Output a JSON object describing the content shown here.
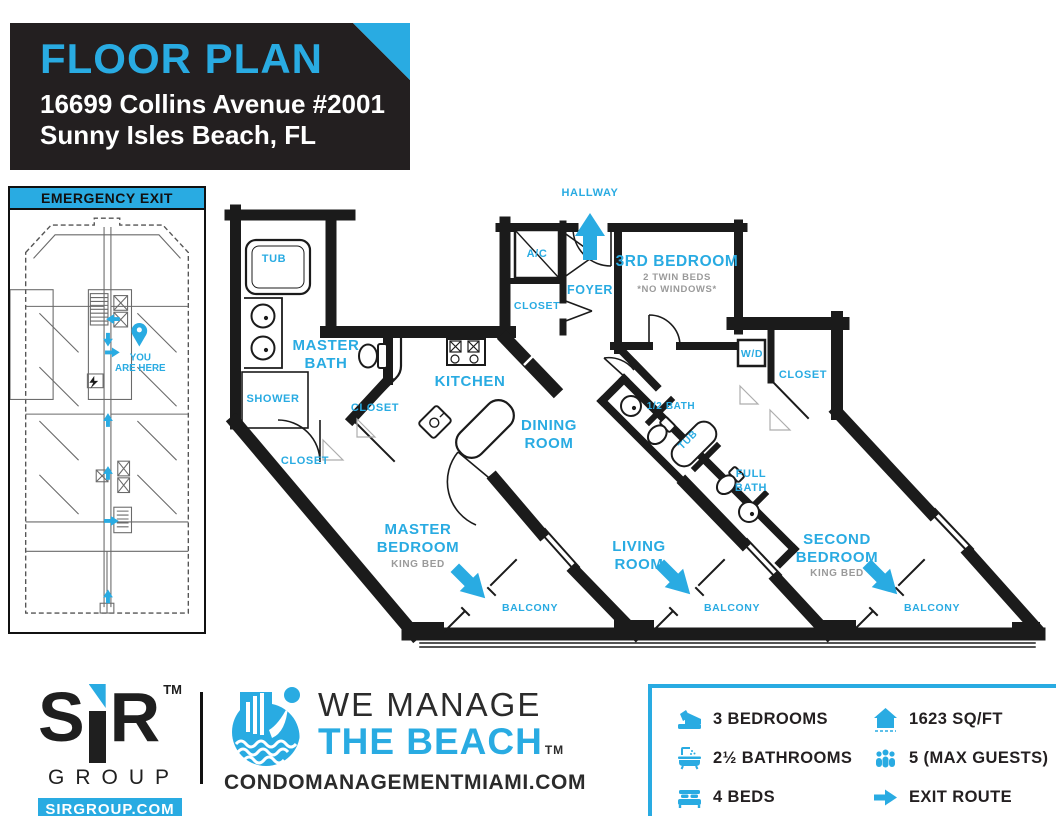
{
  "colors": {
    "accent": "#29ABE2",
    "ink": "#231F20",
    "wall": "#1B1B1B",
    "sub_gray": "#9A9A9A"
  },
  "header": {
    "title": "FLOOR PLAN",
    "address_line1": "16699 Collins Avenue #2001",
    "address_line2": "Sunny Isles Beach, FL"
  },
  "emergency": {
    "title": "EMERGENCY EXIT",
    "marker_line1": "YOU",
    "marker_line2": "ARE HERE"
  },
  "floorplan": {
    "hallway": "HALLWAY",
    "foyer": "FOYER",
    "ac": "A/C",
    "closet_foyer": "CLOSET",
    "master_bath_l1": "MASTER",
    "master_bath_l2": "BATH",
    "tub_master": "TUB",
    "shower": "SHOWER",
    "closet_hall": "CLOSET",
    "closet_master": "CLOSET",
    "kitchen": "KITCHEN",
    "dining_l1": "DINING",
    "dining_l2": "ROOM",
    "third_bedroom": "3RD BEDROOM",
    "third_bedroom_sub1": "2 TWIN BEDS",
    "third_bedroom_sub2": "*NO WINDOWS*",
    "wd": "W/D",
    "closet_second": "CLOSET",
    "half_bath": "1/2 BATH",
    "tub_hall": "TUB",
    "full_bath_l1": "FULL",
    "full_bath_l2": "BATH",
    "master_bedroom_l1": "MASTER",
    "master_bedroom_l2": "BEDROOM",
    "master_bedroom_sub": "KING BED",
    "living_l1": "LIVING",
    "living_l2": "ROOM",
    "second_bedroom_l1": "SECOND",
    "second_bedroom_l2": "BEDROOM",
    "second_bedroom_sub": "KING BED",
    "balcony_master": "BALCONY",
    "balcony_living": "BALCONY",
    "balcony_second": "BALCONY"
  },
  "footer": {
    "sir_s": "S",
    "sir_r": "R",
    "sir_tm": "TM",
    "sir_group": "GROUP",
    "sir_url": "SIRGROUP.COM",
    "tagline_line1": "WE MANAGE",
    "tagline_line2": "THE BEACH",
    "tagline_tm": "TM",
    "website": "CONDOMANAGEMENTMIAMI.COM",
    "stats": [
      {
        "icon": "bed-icon",
        "label": "3 BEDROOMS"
      },
      {
        "icon": "bath-icon",
        "label": "2½ BATHROOMS"
      },
      {
        "icon": "beds-icon",
        "label": "4 BEDS"
      },
      {
        "icon": "house-icon",
        "label": "1623 SQ/FT"
      },
      {
        "icon": "guests-icon",
        "label": "5 (MAX GUESTS)"
      },
      {
        "icon": "exit-arrow-icon",
        "label": "EXIT ROUTE"
      }
    ]
  }
}
